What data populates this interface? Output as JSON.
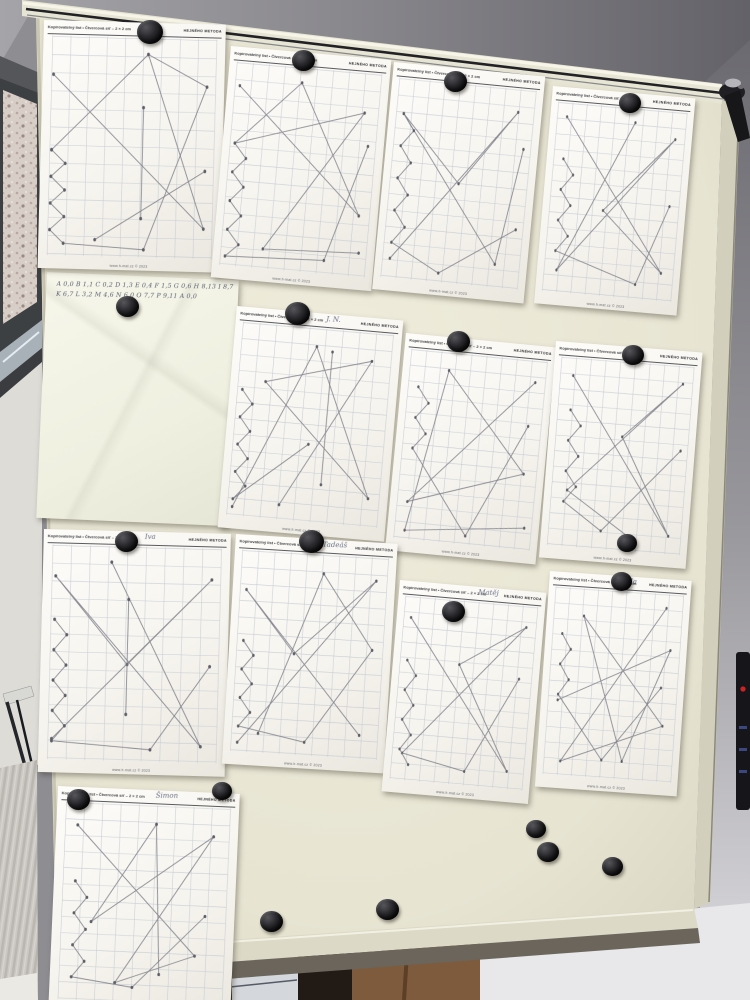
{
  "worksheet": {
    "header_left": "Kopírovatelný list • Čtvercová síť – 2 × 2 cm",
    "brand": "HEJNÉHO METODA",
    "footer": "www.h-mat.cz © 2023"
  },
  "note": {
    "box": [
      47,
      272,
      192,
      246,
      2.5
    ],
    "lines": [
      "A 0,0  B 1,1  C 0,2  D 1,3  E 0,4  F 1,5  G 0,6  H 8,13  I 8,7  J 0,9  K 10,11",
      "K 6,7  L 3,2   M 4,6   N 6,0   O 7,7   P 9,11   A 0,0"
    ]
  },
  "papers": [
    {
      "name": "",
      "box": [
        44,
        20,
        182,
        248,
        1.5
      ],
      "lines": [
        [
          [
            4,
            18
          ],
          [
            92,
            86
          ],
          [
            58,
            8
          ],
          [
            4,
            52
          ]
        ],
        [
          [
            4,
            52
          ],
          [
            12,
            58
          ],
          [
            4,
            64
          ],
          [
            12,
            70
          ],
          [
            4,
            76
          ],
          [
            12,
            82
          ],
          [
            4,
            88
          ],
          [
            12,
            94
          ],
          [
            58,
            96
          ],
          [
            92,
            22
          ],
          [
            58,
            8
          ]
        ],
        [
          [
            56,
            32
          ],
          [
            56,
            82
          ]
        ],
        [
          [
            92,
            60
          ],
          [
            30,
            92
          ]
        ]
      ]
    },
    {
      "name": "",
      "box": [
        231,
        46,
        161,
        232,
        5
      ],
      "lines": [
        [
          [
            6,
            12
          ],
          [
            90,
            70
          ],
          [
            46,
            8
          ],
          [
            6,
            40
          ],
          [
            88,
            20
          ],
          [
            30,
            90
          ],
          [
            92,
            88
          ]
        ],
        [
          [
            6,
            40
          ],
          [
            14,
            47
          ],
          [
            6,
            54
          ],
          [
            14,
            61
          ],
          [
            6,
            68
          ],
          [
            14,
            75
          ],
          [
            6,
            82
          ],
          [
            14,
            89
          ],
          [
            6,
            95
          ],
          [
            70,
            93
          ],
          [
            92,
            36
          ]
        ]
      ]
    },
    {
      "name": "",
      "box": [
        394,
        62,
        152,
        228,
        5.5
      ],
      "lines": [
        [
          [
            8,
            90
          ],
          [
            86,
            12
          ],
          [
            50,
            50
          ],
          [
            8,
            18
          ],
          [
            80,
            88
          ],
          [
            92,
            30
          ]
        ],
        [
          [
            8,
            18
          ],
          [
            16,
            26
          ],
          [
            8,
            34
          ],
          [
            16,
            42
          ],
          [
            8,
            50
          ],
          [
            16,
            58
          ],
          [
            8,
            66
          ],
          [
            16,
            74
          ],
          [
            8,
            82
          ],
          [
            42,
            95
          ],
          [
            92,
            70
          ]
        ]
      ]
    },
    {
      "name": "",
      "box": [
        553,
        86,
        143,
        218,
        5
      ],
      "lines": [
        [
          [
            10,
            8
          ],
          [
            88,
            85
          ],
          [
            42,
            55
          ],
          [
            90,
            15
          ],
          [
            12,
            88
          ],
          [
            60,
            8
          ]
        ],
        [
          [
            10,
            30
          ],
          [
            18,
            38
          ],
          [
            10,
            46
          ],
          [
            18,
            54
          ],
          [
            10,
            62
          ],
          [
            18,
            70
          ],
          [
            10,
            78
          ],
          [
            70,
            92
          ],
          [
            90,
            50
          ]
        ]
      ]
    },
    {
      "name": "J. N.",
      "box": [
        237,
        306,
        167,
        222,
        5
      ],
      "lines": [
        [
          [
            6,
            95
          ],
          [
            50,
            10
          ],
          [
            90,
            85
          ],
          [
            20,
            30
          ],
          [
            85,
            15
          ],
          [
            35,
            92
          ]
        ],
        [
          [
            6,
            35
          ],
          [
            13,
            42
          ],
          [
            6,
            49
          ],
          [
            13,
            56
          ],
          [
            6,
            63
          ],
          [
            13,
            70
          ],
          [
            6,
            77
          ],
          [
            13,
            84
          ],
          [
            6,
            91
          ],
          [
            50,
            60
          ]
        ],
        [
          [
            60,
            12
          ],
          [
            60,
            80
          ]
        ]
      ]
    },
    {
      "name": "",
      "box": [
        406,
        333,
        151,
        218,
        5.5
      ],
      "lines": [
        [
          [
            90,
            12
          ],
          [
            10,
            80
          ],
          [
            88,
            60
          ],
          [
            30,
            10
          ],
          [
            10,
            95
          ],
          [
            92,
            88
          ]
        ],
        [
          [
            10,
            20
          ],
          [
            18,
            28
          ],
          [
            10,
            36
          ],
          [
            18,
            44
          ],
          [
            10,
            52
          ],
          [
            52,
            95
          ],
          [
            88,
            35
          ]
        ]
      ]
    },
    {
      "name": "",
      "box": [
        556,
        341,
        147,
        217,
        4.5
      ],
      "lines": [
        [
          [
            12,
            10
          ],
          [
            88,
            90
          ],
          [
            50,
            40
          ],
          [
            90,
            10
          ],
          [
            14,
            70
          ],
          [
            60,
            92
          ]
        ],
        [
          [
            12,
            28
          ],
          [
            20,
            36
          ],
          [
            12,
            44
          ],
          [
            20,
            52
          ],
          [
            12,
            60
          ],
          [
            20,
            68
          ],
          [
            12,
            76
          ],
          [
            40,
            90
          ],
          [
            92,
            45
          ]
        ]
      ]
    },
    {
      "name": "Iva",
      "box": [
        44,
        529,
        187,
        243,
        1.5
      ],
      "lines": [
        [
          [
            5,
            90
          ],
          [
            92,
            15
          ],
          [
            46,
            55
          ],
          [
            5,
            15
          ],
          [
            88,
            92
          ],
          [
            36,
            8
          ]
        ],
        [
          [
            5,
            35
          ],
          [
            12,
            42
          ],
          [
            5,
            49
          ],
          [
            12,
            56
          ],
          [
            5,
            63
          ],
          [
            12,
            70
          ],
          [
            5,
            77
          ],
          [
            12,
            84
          ],
          [
            5,
            91
          ],
          [
            60,
            94
          ],
          [
            92,
            55
          ]
        ],
        [
          [
            46,
            25
          ],
          [
            46,
            78
          ]
        ]
      ]
    },
    {
      "name": "Tadeáš",
      "box": [
        236,
        534,
        162,
        230,
        3.5
      ],
      "lines": [
        [
          [
            7,
            95
          ],
          [
            90,
            12
          ],
          [
            40,
            50
          ],
          [
            7,
            20
          ],
          [
            85,
            88
          ]
        ],
        [
          [
            7,
            45
          ],
          [
            14,
            52
          ],
          [
            7,
            59
          ],
          [
            14,
            66
          ],
          [
            7,
            73
          ],
          [
            14,
            80
          ],
          [
            7,
            87
          ],
          [
            50,
            93
          ],
          [
            90,
            46
          ],
          [
            56,
            10
          ],
          [
            20,
            90
          ]
        ]
      ]
    },
    {
      "name": "Matěj",
      "box": [
        400,
        580,
        147,
        212,
        5
      ],
      "lines": [
        [
          [
            8,
            12
          ],
          [
            85,
            90
          ],
          [
            45,
            35
          ],
          [
            90,
            12
          ],
          [
            10,
            85
          ],
          [
            55,
            92
          ],
          [
            88,
            40
          ]
        ],
        [
          [
            8,
            35
          ],
          [
            15,
            43
          ],
          [
            8,
            51
          ],
          [
            15,
            59
          ],
          [
            8,
            67
          ],
          [
            15,
            75
          ],
          [
            8,
            83
          ],
          [
            15,
            91
          ]
        ]
      ]
    },
    {
      "name": "Ela",
      "box": [
        550,
        571,
        142,
        216,
        4
      ],
      "lines": [
        [
          [
            85,
            8
          ],
          [
            15,
            92
          ],
          [
            88,
            70
          ],
          [
            25,
            15
          ],
          [
            60,
            90
          ],
          [
            90,
            30
          ],
          [
            10,
            60
          ]
        ],
        [
          [
            10,
            25
          ],
          [
            17,
            33
          ],
          [
            10,
            41
          ],
          [
            17,
            49
          ],
          [
            10,
            57
          ],
          [
            45,
            90
          ],
          [
            85,
            50
          ]
        ]
      ]
    },
    {
      "name": "Šimon",
      "box": [
        58,
        786,
        182,
        226,
        2.5
      ],
      "lines": [
        [
          [
            10,
            12
          ],
          [
            80,
            75
          ],
          [
            35,
            90
          ],
          [
            88,
            15
          ],
          [
            20,
            60
          ],
          [
            55,
            10
          ],
          [
            60,
            85
          ]
        ],
        [
          [
            10,
            40
          ],
          [
            17,
            48
          ],
          [
            10,
            56
          ],
          [
            17,
            64
          ],
          [
            10,
            72
          ],
          [
            17,
            80
          ],
          [
            10,
            88
          ],
          [
            45,
            92
          ],
          [
            85,
            55
          ]
        ]
      ]
    }
  ],
  "magnets": [
    [
      150,
      33,
      26
    ],
    [
      303,
      61,
      23
    ],
    [
      455,
      82,
      23
    ],
    [
      630,
      104,
      22
    ],
    [
      127,
      307,
      23
    ],
    [
      297,
      314,
      25
    ],
    [
      458,
      342,
      23
    ],
    [
      633,
      356,
      22
    ],
    [
      627,
      544,
      20
    ],
    [
      126,
      542,
      23
    ],
    [
      311,
      542,
      25
    ],
    [
      453,
      612,
      23
    ],
    [
      621,
      582,
      21
    ],
    [
      78,
      800,
      23
    ],
    [
      222,
      792,
      20
    ],
    [
      536,
      830,
      20
    ],
    [
      548,
      853,
      22
    ],
    [
      612,
      867,
      21
    ],
    [
      271,
      922,
      23
    ],
    [
      387,
      910,
      23
    ]
  ],
  "colors": {
    "board": "#e9e6d4",
    "frame": "#d8d5c2",
    "wall_dark": "#6e6d73",
    "wall_light": "#d8d7da",
    "paper": "#fbfaf6",
    "note_paper": "#f3f3e6",
    "brick": "#d7cec7",
    "blanket": "#cbc7c2",
    "wood": "#7e5b3c",
    "magnet": "#141416",
    "pencil": "#80808a",
    "indicator_red": "#cc2222"
  }
}
